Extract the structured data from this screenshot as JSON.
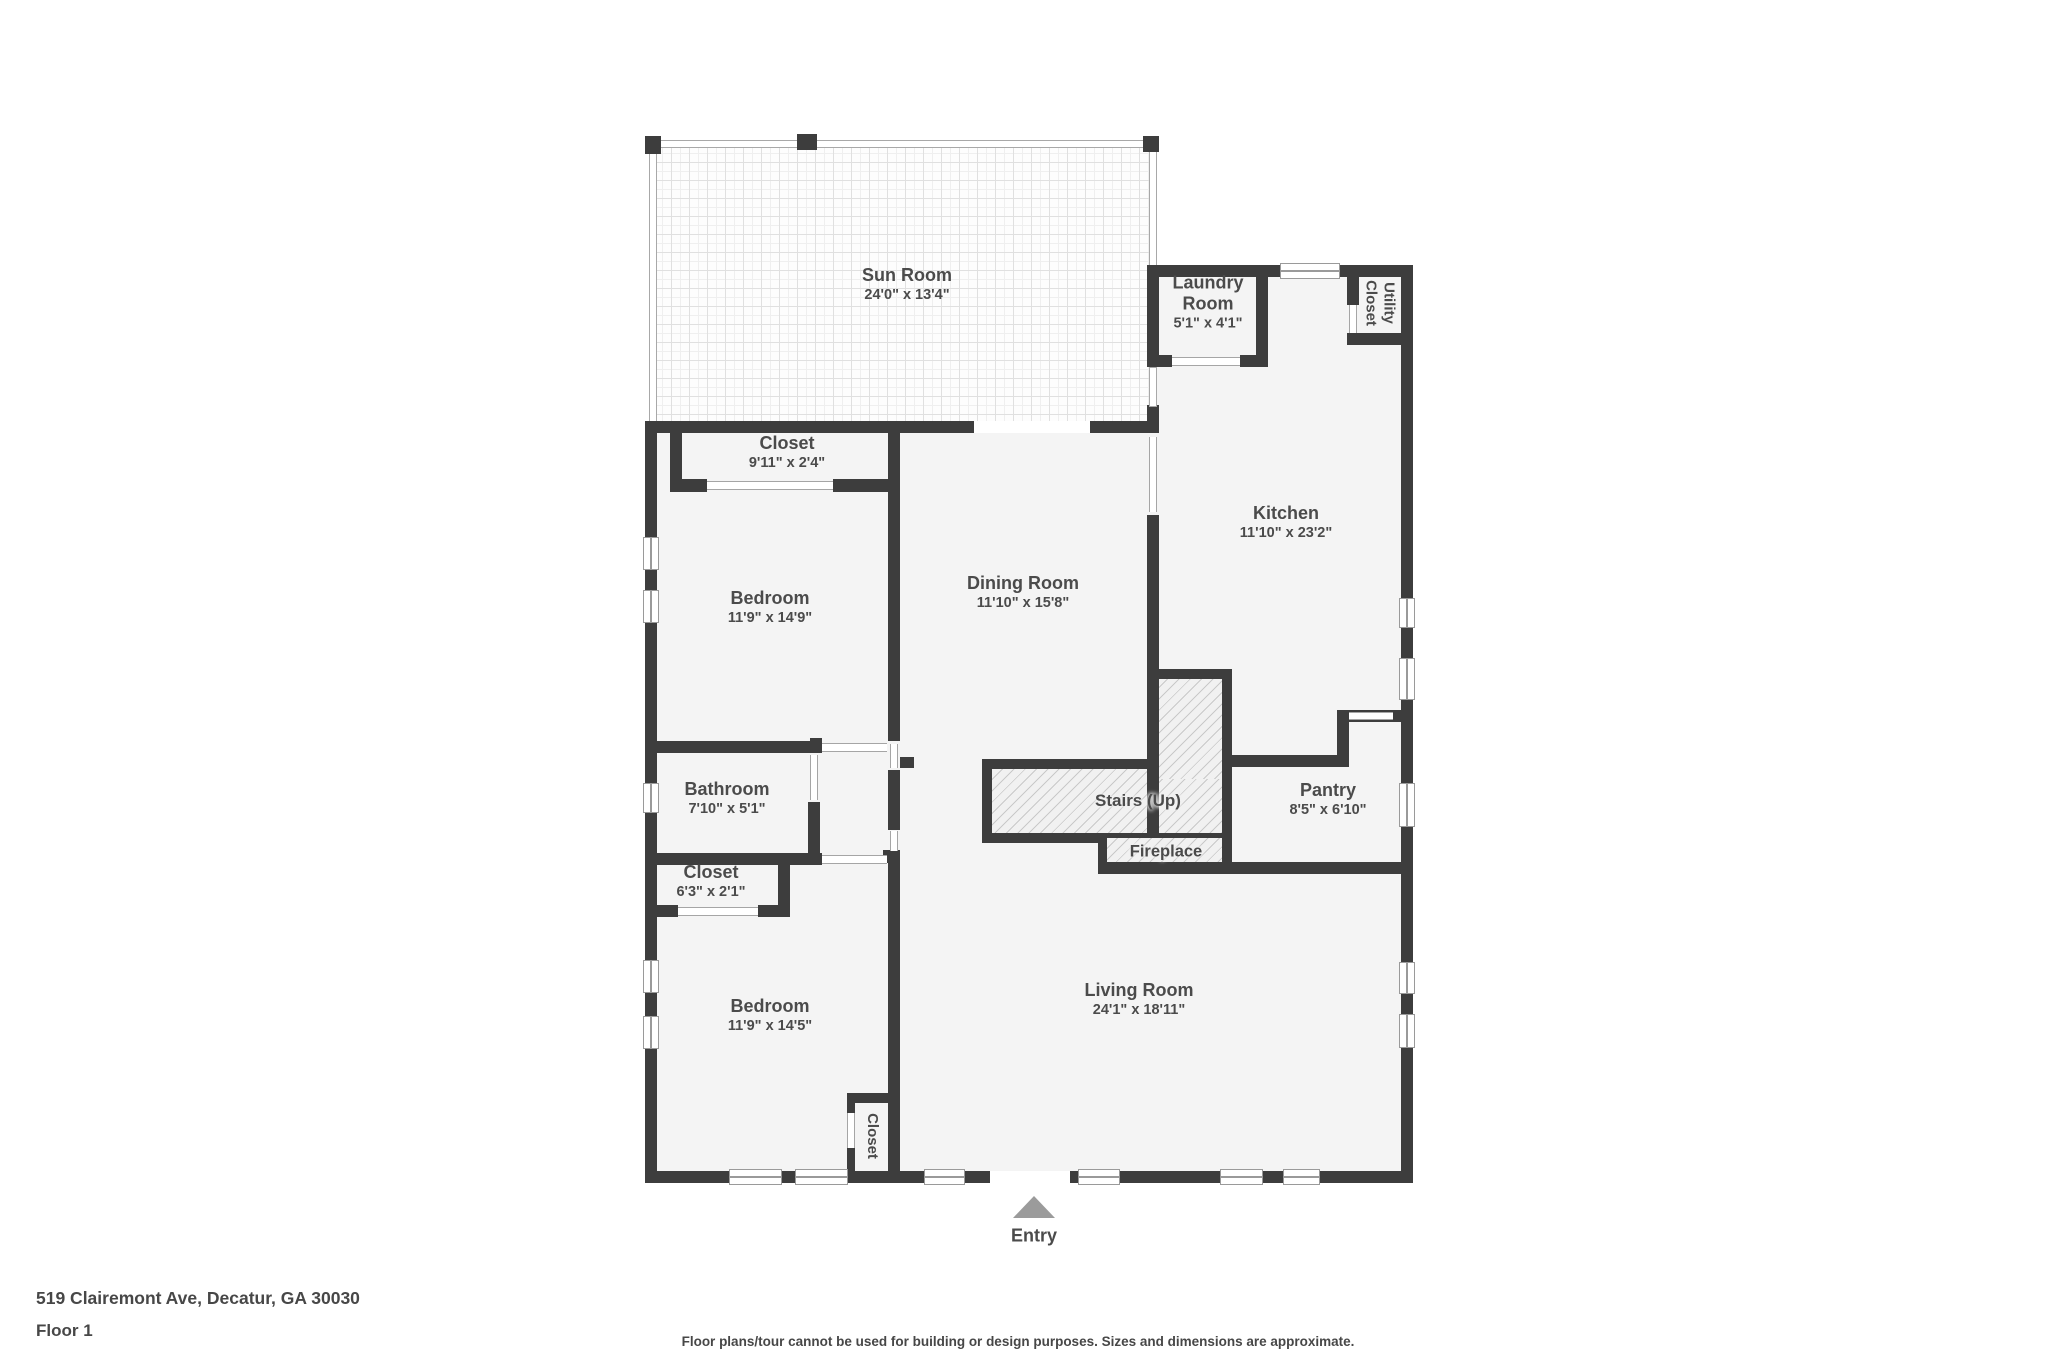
{
  "colors": {
    "wall": "#3d3d3d",
    "room_fill": "#f4f4f4",
    "hatch_line": "#c9c9c9",
    "entry_arrow": "#9b9b9b",
    "label_text": "#4b4b4b"
  },
  "rooms": {
    "sun_room": {
      "name": "Sun Room",
      "dims": "24'0\" x 13'4\""
    },
    "laundry": {
      "name": "Laundry Room",
      "dims": "5'1\" x 4'1\""
    },
    "utility_closet": {
      "name": "Utility Closet"
    },
    "closet_top": {
      "name": "Closet",
      "dims": "9'11\" x 2'4\""
    },
    "kitchen": {
      "name": "Kitchen",
      "dims": "11'10\" x 23'2\""
    },
    "bedroom_top": {
      "name": "Bedroom",
      "dims": "11'9\" x 14'9\""
    },
    "dining": {
      "name": "Dining Room",
      "dims": "11'10\" x 15'8\""
    },
    "bathroom": {
      "name": "Bathroom",
      "dims": "7'10\" x 5'1\""
    },
    "closet_mid": {
      "name": "Closet",
      "dims": "6'3\" x 2'1\""
    },
    "stairs": {
      "name": "Stairs (Up)"
    },
    "fireplace": {
      "name": "Fireplace"
    },
    "pantry": {
      "name": "Pantry",
      "dims": "8'5\" x 6'10\""
    },
    "bedroom_bottom": {
      "name": "Bedroom",
      "dims": "11'9\" x 14'5\""
    },
    "living": {
      "name": "Living Room",
      "dims": "24'1\" x 18'11\""
    },
    "closet_bottom": {
      "name": "Closet"
    }
  },
  "entry": {
    "label": "Entry"
  },
  "footer": {
    "address": "519 Clairemont Ave, Decatur, GA 30030",
    "floor": "Floor 1",
    "disclaimer": "Floor plans/tour cannot be used for building or design purposes. Sizes and dimensions are approximate."
  }
}
